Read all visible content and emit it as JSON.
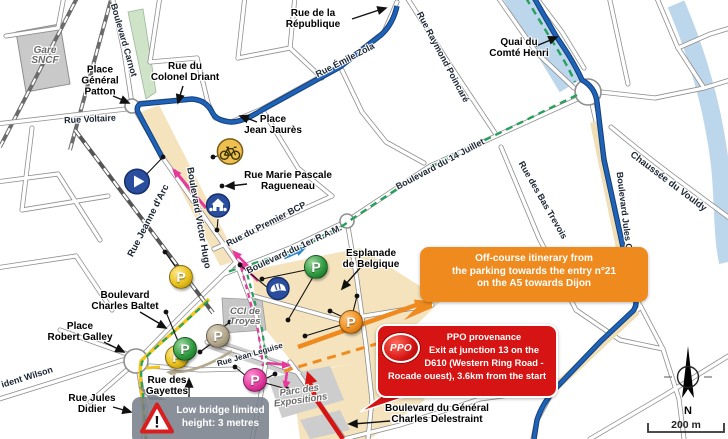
{
  "callouts": {
    "off_course": {
      "color": "#ef8a1f",
      "lines": [
        "Off-course itinerary from",
        "the parking towards the entry n°21",
        "on the A5 towards Dijon"
      ]
    },
    "ppo_provenance": {
      "color": "#d61414",
      "badge": "PPO",
      "lines": [
        "PPO provenance",
        "Exit at junction 13 on the",
        "D610 (Western Ring Road -",
        "Rocade ouest), 3.6km from the start"
      ]
    },
    "low_bridge": {
      "color": "#747c88",
      "warning_mark": "!",
      "lines": [
        "Low bridge limited",
        "height: 3 metres"
      ]
    }
  },
  "labels": {
    "gare": [
      "Gare",
      "SNCF"
    ],
    "place_patton": [
      "Place",
      "Général",
      "Patton"
    ],
    "carnot": "Boulevard Carnot",
    "voltaire": "Rue Voltaire",
    "driant": [
      "Rue du",
      "Colonel Driant"
    ],
    "republique": [
      "Rue de la",
      "République"
    ],
    "zola": "Rue Émile Zola",
    "poincare": "Rue Raymond Poincaré",
    "quai_comte_henri": [
      "Quai du",
      "Comté Henri"
    ],
    "place_jean_jaures": [
      "Place",
      "Jean Jaurès"
    ],
    "ragueneau": [
      "Rue Marie Pascale",
      "Ragueneau"
    ],
    "premier_bcp": "Rue du Premier BCP",
    "ram": "Boulevard du 1er R.A.M.",
    "quatorze_juillet": "Boulevard du 14 Juillet",
    "bas_trevois": "Rue des Bas Trevois",
    "vouldy": "Chaussée du Vouldy",
    "jules_guesde": "Boulevard Jules Guesde",
    "esplanade": [
      "Esplanade",
      "de Belgique"
    ],
    "jeanne_darc": "Rue Jeanne d'Arc",
    "victor_hugo": "Boulevard Victor Hugo",
    "baltet": [
      "Boulevard",
      "Charles Baltet"
    ],
    "robert_galley": [
      "Place",
      "Robert Galley"
    ],
    "wilson": "ident Wilson",
    "jules_didier": [
      "Rue Jules",
      "Didier"
    ],
    "gayettes": [
      "Rue des",
      "Gayettes"
    ],
    "cci": [
      "CCI de",
      "Troyes"
    ],
    "jean_leguise": "Rue Jean Leguise",
    "parc_expositions": [
      "Parc des",
      "Expositions"
    ],
    "delestraint": [
      "Boulevard du Général",
      "Charles Delestraint"
    ]
  },
  "map_marks": {
    "north": "N",
    "scale": "200 m",
    "parking_letter": "P"
  },
  "route_colors": {
    "course_blue": "#1e63b8",
    "access_green": "#27a05c",
    "parking_route_yellow": "#f2c51d",
    "pedestrian_pink": "#e8389b",
    "off_course_orange": "#ef8a1f",
    "ppo_red": "#d61414",
    "water": "#bcd6eb",
    "parking_zone_beige": "#f5e3bd"
  }
}
